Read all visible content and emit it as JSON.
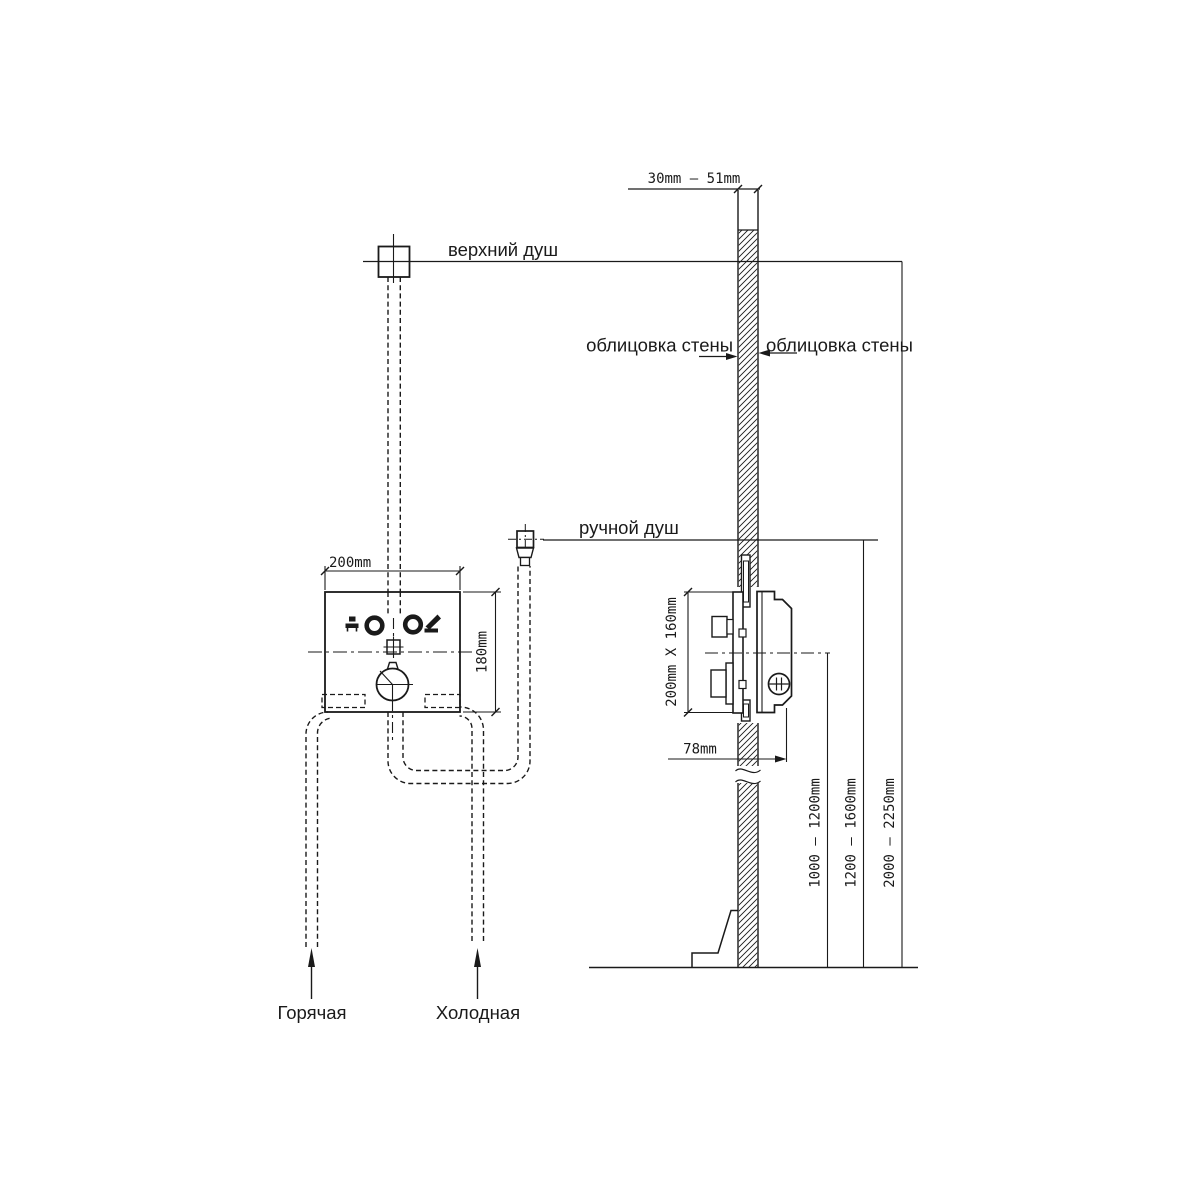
{
  "diagram": {
    "labels": {
      "top_shower": "верхний душ",
      "hand_shower": "ручной душ",
      "cladding_left": "облицовка стены",
      "cladding_right": "облицовка стены",
      "hot": "Горячая",
      "cold": "Холодная"
    },
    "dimensions": {
      "wall_thickness_range": "30mm  —  51mm",
      "front_width": "200mm",
      "front_height": "180mm",
      "rough_in_size": "200mm  X  160mm",
      "outlet_offset": "78mm",
      "mixer_height_range": "1000 — 1200mm",
      "hand_shower_height_range": "1200 — 1600mm",
      "top_shower_height_range": "2000 — 2250mm"
    },
    "icons": {
      "left_port": "overhead-shower-icon",
      "right_port": "hand-shower-icon"
    },
    "colors": {
      "line": "#1a1a1a",
      "background": "#ffffff"
    }
  }
}
